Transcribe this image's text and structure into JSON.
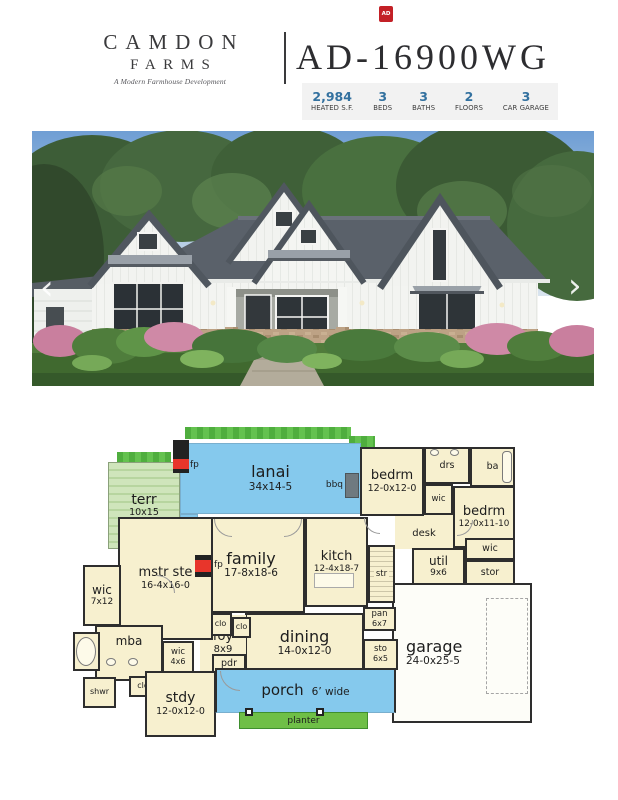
{
  "header": {
    "brand_line1": "CAMDON",
    "brand_line2": "FARMS",
    "tagline": "A Modern Farmhouse Development",
    "plan_number": "AD-16900WG",
    "badge": "AD"
  },
  "stats": {
    "items": [
      {
        "value": "2,984",
        "label": "HEATED S.F."
      },
      {
        "value": "3",
        "label": "BEDS"
      },
      {
        "value": "3",
        "label": "BATHS"
      },
      {
        "value": "2",
        "label": "FLOORS"
      },
      {
        "value": "3",
        "label": "CAR GARAGE"
      }
    ]
  },
  "photo": {
    "prev_icon": "‹",
    "next_icon": "›"
  },
  "plan": {
    "rooms": [
      {
        "name": "terr",
        "dims": "10x15"
      },
      {
        "name": "lanai",
        "dims": "34x14-5"
      },
      {
        "name": "bedrm",
        "dims": "12-0x12-0"
      },
      {
        "name": "drs"
      },
      {
        "name": "ba"
      },
      {
        "name": "wic"
      },
      {
        "name": "bedrm",
        "dims": "12-0x11-10"
      },
      {
        "name": "desk"
      },
      {
        "name": "wic"
      },
      {
        "name": "util",
        "dims": "9x6"
      },
      {
        "name": "stor"
      },
      {
        "name": "garage",
        "dims": "24-0x25-5"
      },
      {
        "name": "family",
        "dims": "17-8x18-6"
      },
      {
        "name": "kitch",
        "dims": "12-4x18-7"
      },
      {
        "name": "str"
      },
      {
        "name": "pan",
        "dims": "6x7"
      },
      {
        "name": "sto",
        "dims": "6x5"
      },
      {
        "name": "dining",
        "dims": "14-0x12-0"
      },
      {
        "name": "foy",
        "dims": "8x9"
      },
      {
        "name": "clo"
      },
      {
        "name": "clo"
      },
      {
        "name": "mstr ste",
        "dims": "16-4x16-0"
      },
      {
        "name": "wic",
        "dims": "7x12"
      },
      {
        "name": "mba"
      },
      {
        "name": "tub"
      },
      {
        "name": "wic",
        "dims": "4x6"
      },
      {
        "name": "shwr"
      },
      {
        "name": "clo"
      },
      {
        "name": "pdr"
      },
      {
        "name": "stdy",
        "dims": "12-0x12-0"
      },
      {
        "name": "porch",
        "dims": "6’ wide"
      },
      {
        "name": "planter"
      }
    ],
    "markers": {
      "fp_top": "fp",
      "fp_family": "fp",
      "bbq": "bbq"
    }
  },
  "colors": {
    "accent_red": "#c32026",
    "stat_number_blue": "#33719f",
    "plan_cream": "#f7f0cf",
    "plan_blue": "#85c9ed",
    "hedge_green": "#57b847",
    "terrace_green": "#c8e0b0",
    "planter_green": "#6fbf47",
    "wall_dark": "#2e2e2e",
    "fireplace_red": "#e8352b"
  }
}
